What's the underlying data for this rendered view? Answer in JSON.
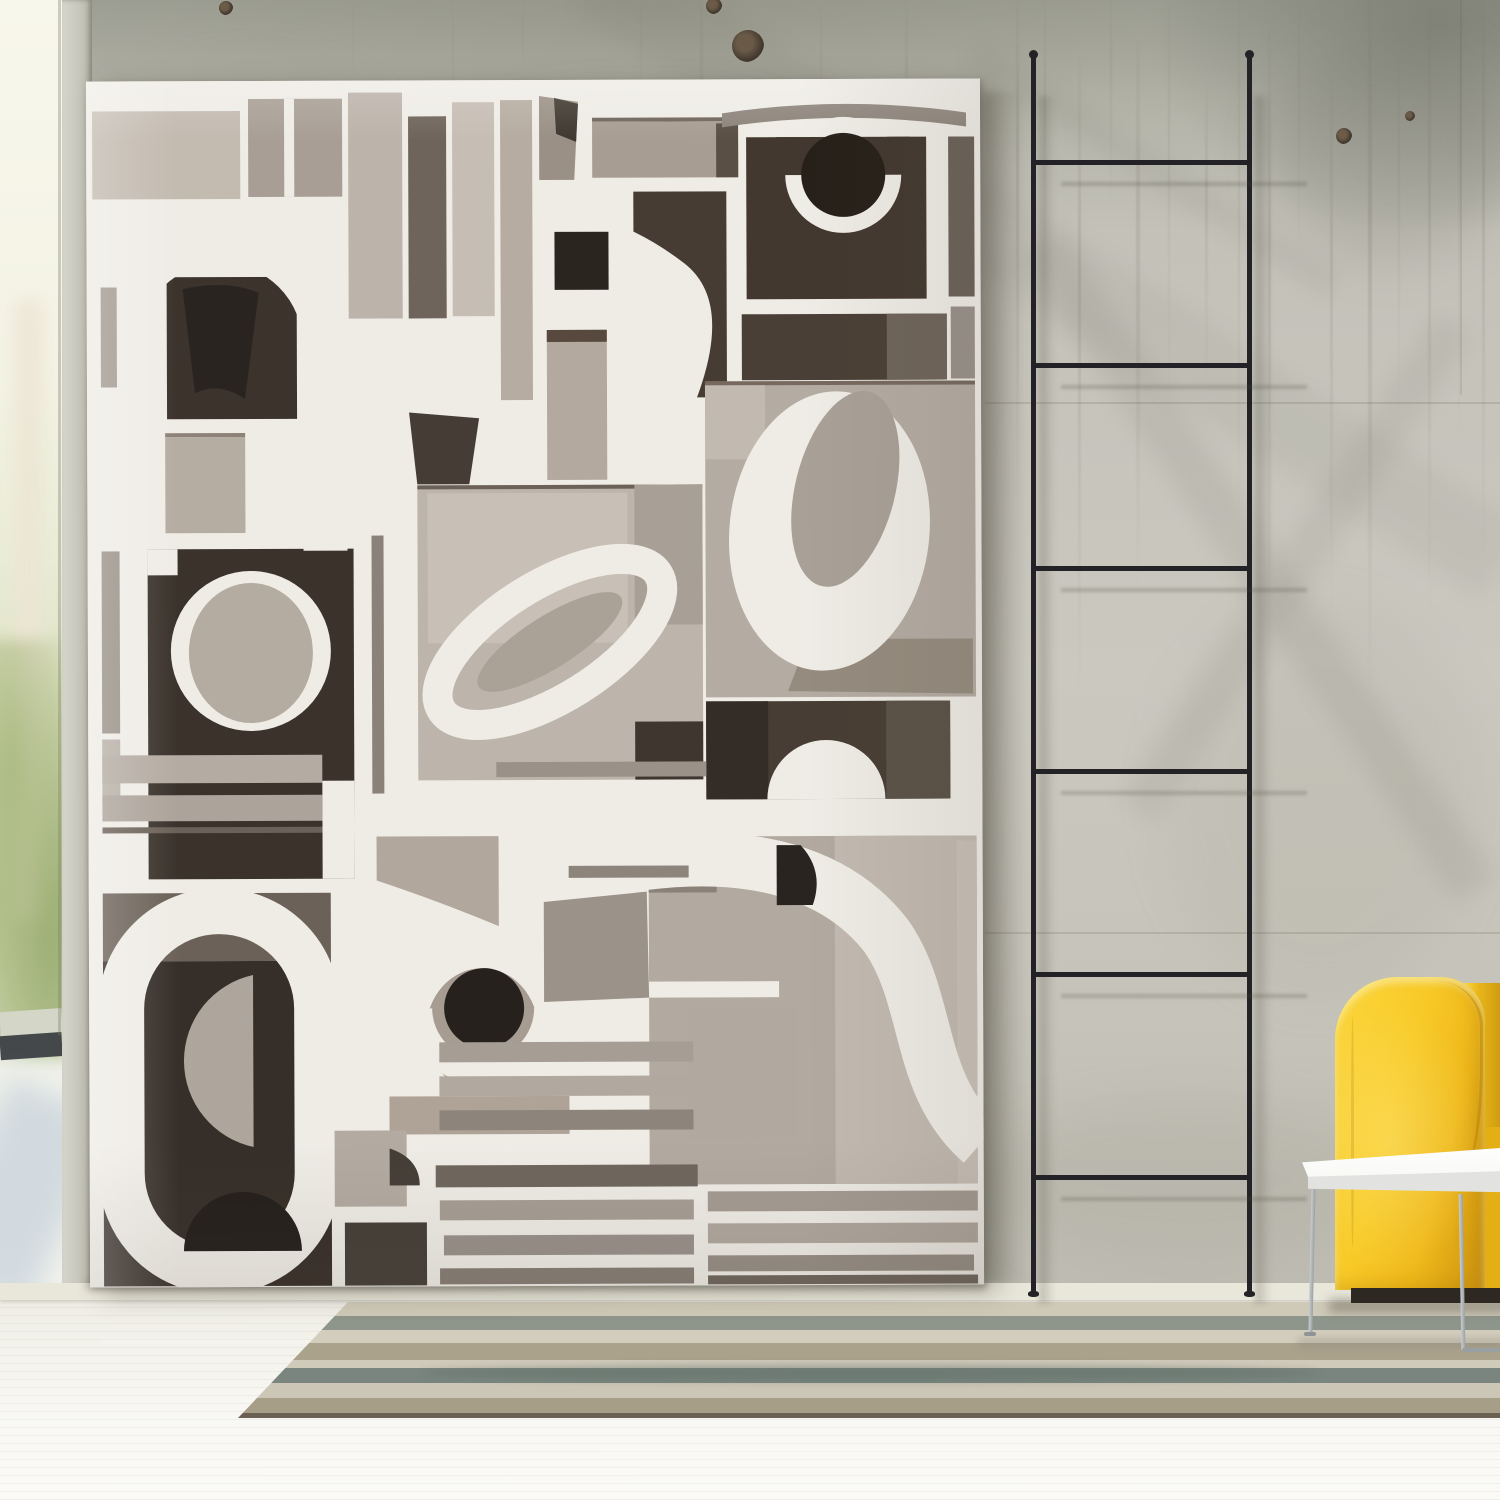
{
  "scene": {
    "description": "Interior photo: large monochrome paper-cutout abstract artwork leaning on a weathered concrete wall, thin black decor ladder, yellow sofa corner with white side table, striped rug on white wood floor, bright window at left",
    "objects": [
      "abstract-artwork-canvas",
      "concrete-wall",
      "black-ladder",
      "yellow-sofa",
      "white-side-table",
      "striped-rug",
      "white-floor",
      "window-light"
    ]
  },
  "palette": {
    "paper": "#efece6",
    "ladder": "#232327",
    "wall_base": "#c7c5bc",
    "floor": "#f2f1ea",
    "sofa_yellow": "#f8ca27",
    "sofa_base": "#2d2922",
    "table_white": "#fbfbf8",
    "table_leg": "#9aa0a3",
    "window_green": "#c2cda0",
    "art_dark": "#3a322b",
    "art_black": "#262019",
    "art_gray": "#a89e95",
    "art_light": "#c6bdb4"
  },
  "wall": {
    "streaks": [
      {
        "x": 1016,
        "y": 0,
        "w": 3,
        "h": 520,
        "o": 0.2
      },
      {
        "x": 1044,
        "y": 0,
        "w": 2,
        "h": 300,
        "o": 0.14
      },
      {
        "x": 1078,
        "y": 60,
        "w": 3,
        "h": 640,
        "o": 0.18
      },
      {
        "x": 1110,
        "y": 0,
        "w": 2,
        "h": 210,
        "o": 0.12
      },
      {
        "x": 1136,
        "y": 40,
        "w": 4,
        "h": 560,
        "o": 0.16
      },
      {
        "x": 1168,
        "y": 0,
        "w": 2,
        "h": 420,
        "o": 0.12
      },
      {
        "x": 1205,
        "y": 90,
        "w": 3,
        "h": 300,
        "o": 0.14
      },
      {
        "x": 1238,
        "y": 0,
        "w": 2,
        "h": 520,
        "o": 0.12
      },
      {
        "x": 1268,
        "y": 30,
        "w": 3,
        "h": 660,
        "o": 0.17
      },
      {
        "x": 1298,
        "y": 0,
        "w": 2,
        "h": 260,
        "o": 0.1
      },
      {
        "x": 1330,
        "y": 80,
        "w": 3,
        "h": 540,
        "o": 0.15
      },
      {
        "x": 1368,
        "y": 0,
        "w": 4,
        "h": 700,
        "o": 0.2
      },
      {
        "x": 1398,
        "y": 60,
        "w": 2,
        "h": 360,
        "o": 0.12
      },
      {
        "x": 1428,
        "y": 0,
        "w": 3,
        "h": 620,
        "o": 0.16
      },
      {
        "x": 1458,
        "y": 20,
        "w": 2,
        "h": 430,
        "o": 0.12
      },
      {
        "x": 1482,
        "y": 0,
        "w": 3,
        "h": 560,
        "o": 0.18
      },
      {
        "x": 700,
        "y": 0,
        "w": 3,
        "h": 180,
        "o": 0.1
      },
      {
        "x": 762,
        "y": 90,
        "w": 3,
        "h": 120,
        "o": 0.12
      },
      {
        "x": 820,
        "y": 0,
        "w": 2,
        "h": 150,
        "o": 0.08
      },
      {
        "x": 640,
        "y": 0,
        "w": 2,
        "h": 120,
        "o": 0.08
      },
      {
        "x": 905,
        "y": 0,
        "w": 3,
        "h": 220,
        "o": 0.1
      },
      {
        "x": 452,
        "y": 0,
        "w": 2,
        "h": 130,
        "o": 0.07
      },
      {
        "x": 522,
        "y": 0,
        "w": 2,
        "h": 90,
        "o": 0.06
      },
      {
        "x": 352,
        "y": 0,
        "w": 2,
        "h": 80,
        "o": 0.06
      }
    ],
    "blotches": [
      {
        "x": 60,
        "y": 500,
        "w": 260,
        "h": 420,
        "o": 0.08,
        "c": "#8f8b7d"
      },
      {
        "x": 1160,
        "y": 600,
        "w": 320,
        "h": 400,
        "o": 0.08,
        "c": "#827f71"
      },
      {
        "x": 1270,
        "y": 40,
        "w": 240,
        "h": 220,
        "o": 0.2,
        "c": "#6f7066"
      },
      {
        "x": 420,
        "y": 100,
        "w": 440,
        "h": 170,
        "o": 0.1,
        "c": "#83816f"
      },
      {
        "x": 980,
        "y": 1100,
        "w": 420,
        "h": 160,
        "o": 0.1,
        "c": "#7e7a6a"
      },
      {
        "x": 100,
        "y": 60,
        "w": 300,
        "h": 160,
        "o": 0.08,
        "c": "#8a8876"
      }
    ],
    "seams": [
      {
        "dir": "h",
        "x": 985,
        "y": 402,
        "len": 515
      },
      {
        "dir": "h",
        "x": 985,
        "y": 932,
        "len": 515
      },
      {
        "dir": "v",
        "x": 1460,
        "y": 0,
        "len": 395
      }
    ],
    "knots": [
      {
        "x": 748,
        "y": 46,
        "r": 16
      },
      {
        "x": 714,
        "y": 6,
        "r": 8
      },
      {
        "x": 1344,
        "y": 136,
        "r": 8
      },
      {
        "x": 1410,
        "y": 116,
        "r": 5
      },
      {
        "x": 226,
        "y": 8,
        "r": 7
      }
    ],
    "diag_bands": [
      {
        "x": 620,
        "y": -60,
        "len": 1080,
        "th": 84,
        "rot": 33,
        "o": 0.06
      },
      {
        "x": 1060,
        "y": 230,
        "len": 780,
        "th": 48,
        "rot": 56,
        "o": 0.09
      },
      {
        "x": 1120,
        "y": 800,
        "len": 580,
        "th": 42,
        "rot": -57,
        "o": 0.08
      },
      {
        "x": 980,
        "y": 40,
        "len": 430,
        "th": 28,
        "rot": 33,
        "o": 0.07
      }
    ]
  },
  "ladder": {
    "rail_left_x": 1031,
    "rail_right_x": 1247,
    "rail_width": 5,
    "top_y": 56,
    "bottom_y": 1294,
    "rungs_y": [
      160,
      363,
      566,
      769,
      972,
      1175
    ]
  },
  "rug": {
    "left": 238,
    "top": 1302,
    "width": 1262,
    "corner_inset": 110,
    "stripes": [
      {
        "h": 14,
        "c": "#cfc9b8"
      },
      {
        "h": 14,
        "c": "#8e968c"
      },
      {
        "h": 13,
        "c": "#d3cdbd"
      },
      {
        "h": 17,
        "c": "#aaa28b"
      },
      {
        "h": 8,
        "c": "#d0cabb"
      },
      {
        "h": 15,
        "c": "#79857e"
      },
      {
        "h": 15,
        "c": "#ccc6b6"
      },
      {
        "h": 15,
        "c": "#a79e87"
      },
      {
        "h": 5,
        "c": "#6a6152"
      }
    ]
  },
  "floor_streaks": [
    {
      "x": 100,
      "y": 1340,
      "w": 420,
      "h": 3,
      "o": 0.5
    },
    {
      "x": 600,
      "y": 1450,
      "w": 560,
      "h": 3,
      "o": 0.5
    },
    {
      "x": 260,
      "y": 1470,
      "w": 380,
      "h": 3,
      "o": 0.4
    },
    {
      "x": 900,
      "y": 1430,
      "w": 420,
      "h": 3,
      "o": 0.4
    }
  ],
  "artwork": {
    "x": 88,
    "y": 80,
    "w": 894,
    "h": 1206,
    "shapes": [
      {
        "t": "rect",
        "x": 6,
        "y": 30,
        "w": 148,
        "h": 88,
        "f": "#c3bab0"
      },
      {
        "t": "rect",
        "x": 162,
        "y": 18,
        "w": 94,
        "h": 98,
        "f": "#a89e95"
      },
      {
        "t": "rect",
        "x": 198,
        "y": 18,
        "w": 10,
        "h": 98,
        "f": "#efece6"
      },
      {
        "t": "rect",
        "x": 262,
        "y": 12,
        "w": 54,
        "h": 226,
        "f": "#bcb3aa"
      },
      {
        "t": "rect",
        "x": 322,
        "y": 36,
        "w": 38,
        "h": 202,
        "f": "#6e645b"
      },
      {
        "t": "rect",
        "x": 366,
        "y": 22,
        "w": 42,
        "h": 214,
        "f": "#c6bdb4"
      },
      {
        "t": "rect",
        "x": 414,
        "y": 20,
        "w": 32,
        "h": 300,
        "f": "#b6aca1"
      },
      {
        "t": "path",
        "d": "M453,16 L492,22 L488,100 L453,100 Z",
        "f": "#9a9086"
      },
      {
        "t": "path",
        "d": "M468,18 L492,24 L490,62 L470,54 Z",
        "f": "#3f3830"
      },
      {
        "t": "rect",
        "x": 468,
        "y": 152,
        "w": 54,
        "h": 58,
        "f": "#2b2520"
      },
      {
        "t": "rect",
        "x": 506,
        "y": 38,
        "w": 146,
        "h": 4,
        "f": "#6f655c"
      },
      {
        "t": "rect",
        "x": 506,
        "y": 42,
        "w": 146,
        "h": 56,
        "f": "#a89d92"
      },
      {
        "t": "rect",
        "x": 630,
        "y": 44,
        "w": 22,
        "h": 54,
        "f": "#5a4f45"
      },
      {
        "t": "path",
        "d": "M547,112 L640,112 L640,318 L610,318 Q646,222 598,184 Q572,164 547,152 Z",
        "f": "#463c33"
      },
      {
        "t": "rect",
        "x": 460,
        "y": 250,
        "w": 60,
        "h": 150,
        "f": "#b3a99e"
      },
      {
        "t": "rect",
        "x": 460,
        "y": 250,
        "w": 60,
        "h": 12,
        "f": "#57493d"
      },
      {
        "t": "path",
        "d": "M636,34 Q758,16 880,34 L880,48 Q758,30 636,48 Z",
        "f": "#8d847b"
      },
      {
        "t": "rect",
        "x": 660,
        "y": 58,
        "w": 180,
        "h": 162,
        "f": "#42382f"
      },
      {
        "t": "circle",
        "cx": 757,
        "cy": 96,
        "r": 58,
        "f": "#efece6"
      },
      {
        "t": "rect",
        "x": 690,
        "y": 58,
        "w": 134,
        "h": 38,
        "f": "#42382f"
      },
      {
        "t": "circle",
        "cx": 757,
        "cy": 96,
        "r": 42,
        "f": "#262019"
      },
      {
        "t": "rect",
        "x": 862,
        "y": 58,
        "w": 26,
        "h": 160,
        "f": "#6b6158"
      },
      {
        "t": "rect",
        "x": 655,
        "y": 235,
        "w": 205,
        "h": 66,
        "f": "#4a3f36"
      },
      {
        "t": "rect",
        "x": 800,
        "y": 235,
        "w": 60,
        "h": 66,
        "f": "#6e6459"
      },
      {
        "t": "rect",
        "x": 864,
        "y": 228,
        "w": 24,
        "h": 72,
        "f": "#99908a"
      },
      {
        "t": "rect",
        "x": 618,
        "y": 302,
        "w": 270,
        "h": 316,
        "f": "#b4aba2"
      },
      {
        "t": "rect",
        "x": 618,
        "y": 302,
        "w": 270,
        "h": 4,
        "f": "#77695e"
      },
      {
        "t": "rect",
        "x": 618,
        "y": 306,
        "w": 60,
        "h": 74,
        "f": "#c2b9b0"
      },
      {
        "t": "path",
        "d": "M720,560 L885,560 L885,615 L700,612 Z",
        "f": "#958b7e"
      },
      {
        "t": "ellipse",
        "cx": 742,
        "cy": 452,
        "rx": 100,
        "ry": 140,
        "rot": 6,
        "f": "#efece6"
      },
      {
        "t": "ellipse",
        "cx": 758,
        "cy": 410,
        "rx": 50,
        "ry": 100,
        "rot": 14,
        "f": "#a9a097"
      },
      {
        "t": "rect",
        "x": 618,
        "y": 622,
        "w": 244,
        "h": 98,
        "f": "#473d34"
      },
      {
        "t": "rect",
        "x": 618,
        "y": 622,
        "w": 62,
        "h": 98,
        "f": "#342c26"
      },
      {
        "t": "rect",
        "x": 798,
        "y": 622,
        "w": 64,
        "h": 98,
        "f": "#5a5147"
      },
      {
        "t": "path",
        "d": "M679,720 A59,59 0 0 1 797,720 Z",
        "f": "#efece6"
      },
      {
        "t": "rect",
        "x": 560,
        "y": 757,
        "w": 328,
        "h": 348,
        "f": "#b2a9a0"
      },
      {
        "t": "rect",
        "x": 746,
        "y": 757,
        "w": 142,
        "h": 348,
        "f": "#c2b9b0"
      },
      {
        "t": "rect",
        "x": 560,
        "y": 757,
        "w": 68,
        "h": 56,
        "f": "#8a8178"
      },
      {
        "t": "rect",
        "x": 868,
        "y": 762,
        "w": 20,
        "h": 343,
        "f": "#c9c0b7"
      },
      {
        "t": "rect",
        "x": 598,
        "y": 928,
        "w": 110,
        "h": 130,
        "f": "#b1a89f"
      },
      {
        "t": "rect",
        "x": 560,
        "y": 902,
        "w": 130,
        "h": 16,
        "f": "#efece6"
      },
      {
        "t": "path",
        "d": "M552,784 C660,770 748,792 798,858 C842,922 826,1006 892,1064",
        "s": "#efece6",
        "sw": 54
      },
      {
        "t": "path",
        "d": "M688,766 L712,766 Q736,792 724,826 L688,826 Z",
        "f": "#2a2420"
      },
      {
        "t": "rect",
        "x": 618,
        "y": 1112,
        "w": 270,
        "h": 20,
        "f": "#a49b92"
      },
      {
        "t": "rect",
        "x": 618,
        "y": 1144,
        "w": 270,
        "h": 20,
        "f": "#b0a79e"
      },
      {
        "t": "rect",
        "x": 618,
        "y": 1176,
        "w": 266,
        "h": 16,
        "f": "#968d84"
      },
      {
        "t": "rect",
        "x": 618,
        "y": 1196,
        "w": 270,
        "h": 9,
        "f": "#6e645c"
      },
      {
        "t": "rect",
        "x": 330,
        "y": 405,
        "w": 285,
        "h": 295,
        "f": "#bdb4ab"
      },
      {
        "t": "rect",
        "x": 330,
        "y": 405,
        "w": 285,
        "h": 4,
        "f": "#6b6158"
      },
      {
        "t": "rect",
        "x": 340,
        "y": 413,
        "w": 200,
        "h": 150,
        "f": "#c8bfb6"
      },
      {
        "t": "rect",
        "x": 547,
        "y": 405,
        "w": 68,
        "h": 140,
        "f": "#a89f96"
      },
      {
        "t": "rect",
        "x": 547,
        "y": 642,
        "w": 68,
        "h": 58,
        "f": "#3e362f"
      },
      {
        "t": "path",
        "d": "M322,332 L392,338 L382,404 L330,404 Z",
        "f": "#453d35"
      },
      {
        "t": "ellipse",
        "cx": 462,
        "cy": 562,
        "rx": 128,
        "ry": 56,
        "rot": -32,
        "s": "#efece6",
        "sw": 30
      },
      {
        "t": "ellipse",
        "cx": 462,
        "cy": 562,
        "rx": 84,
        "ry": 26,
        "rot": -32,
        "f": "#aaa197"
      },
      {
        "t": "rect",
        "x": 408,
        "y": 682,
        "w": 210,
        "h": 15,
        "f": "#9a9188"
      },
      {
        "t": "rect",
        "x": 78,
        "y": 352,
        "w": 80,
        "h": 4,
        "f": "#8d8278"
      },
      {
        "t": "rect",
        "x": 78,
        "y": 356,
        "w": 80,
        "h": 96,
        "f": "#b5aca2"
      },
      {
        "t": "rect",
        "x": 14,
        "y": 420,
        "w": 18,
        "h": 232,
        "f": "#9a9188"
      },
      {
        "t": "rect",
        "x": 14,
        "y": 658,
        "w": 18,
        "h": 66,
        "f": "#b8afa6"
      },
      {
        "t": "rect",
        "x": 60,
        "y": 468,
        "w": 206,
        "h": 330,
        "f": "#3a322b"
      },
      {
        "t": "circle",
        "cx": 163,
        "cy": 570,
        "r": 80,
        "f": "#efece6"
      },
      {
        "t": "ellipse",
        "cx": 163,
        "cy": 572,
        "rx": 62,
        "ry": 70,
        "rot": 0,
        "f": "#b4aba1"
      },
      {
        "t": "rect",
        "x": 60,
        "y": 468,
        "w": 30,
        "h": 26,
        "f": "#efece6"
      },
      {
        "t": "rect",
        "x": 234,
        "y": 700,
        "w": 32,
        "h": 98,
        "f": "#efece6"
      },
      {
        "t": "rect",
        "x": 284,
        "y": 455,
        "w": 12,
        "h": 258,
        "f": "#8a8178"
      },
      {
        "t": "rect",
        "x": 80,
        "y": 196,
        "w": 130,
        "h": 142,
        "f": "#3b332c"
      },
      {
        "t": "path",
        "d": "M96,208 Q140,198 172,212 L158,318 Q132,300 108,312 Z",
        "f": "#29241f"
      },
      {
        "t": "path",
        "d": "M30,470 L30,264 A104,104 0 0 1 238,264 L238,470",
        "s": "#efece6",
        "sw": 44
      },
      {
        "t": "rect",
        "x": 14,
        "y": 206,
        "w": 16,
        "h": 100,
        "f": "#a39a91"
      },
      {
        "t": "rect",
        "x": 14,
        "y": 674,
        "w": 220,
        "h": 28,
        "f": "#b4aba2"
      },
      {
        "t": "rect",
        "x": 14,
        "y": 714,
        "w": 220,
        "h": 26,
        "f": "#aca39a"
      },
      {
        "t": "rect",
        "x": 14,
        "y": 746,
        "w": 220,
        "h": 6,
        "f": "#6b6158"
      },
      {
        "t": "rect",
        "x": 14,
        "y": 812,
        "w": 228,
        "h": 68,
        "f": "#6b6158"
      },
      {
        "t": "rect",
        "x": 14,
        "y": 880,
        "w": 228,
        "h": 325,
        "f": "#362e28"
      },
      {
        "t": "rect",
        "x": 32,
        "y": 830,
        "w": 196,
        "h": 360,
        "rx": 98,
        "s": "#efece6",
        "sw": 46
      },
      {
        "t": "path",
        "d": "M164,894 A88,88 0 0 0 164,1066 Z",
        "f": "#aea59c"
      },
      {
        "t": "path",
        "d": "M94,1170 A59,59 0 0 1 212,1170 Z",
        "f": "#241f1b"
      },
      {
        "t": "path",
        "d": "M288,756 L410,756 L410,846 Q348,820 288,800 Z",
        "f": "#b2a79c"
      },
      {
        "t": "rect",
        "x": 480,
        "y": 786,
        "w": 120,
        "h": 12,
        "f": "#8d847b"
      },
      {
        "t": "path",
        "d": "M455,822 L558,812 L560,918 L455,922 Z",
        "f": "#9b9289"
      },
      {
        "t": "ellipse",
        "cx": 393,
        "cy": 950,
        "rx": 56,
        "ry": 62,
        "rot": 0,
        "f": "#a79c91"
      },
      {
        "t": "path",
        "d": "M330,928 A64,64 0 1 0 458,928",
        "s": "#efece6",
        "sw": 26
      },
      {
        "t": "circle",
        "cx": 395,
        "cy": 928,
        "r": 40,
        "f": "#26211d"
      },
      {
        "t": "rect",
        "x": 300,
        "y": 1016,
        "w": 180,
        "h": 38,
        "f": "#aea396"
      },
      {
        "t": "rect",
        "x": 245,
        "y": 1050,
        "w": 72,
        "h": 76,
        "f": "#b3aaa1"
      },
      {
        "t": "path",
        "d": "M300,1068 Q330,1078 330,1105 L300,1105 Z",
        "f": "#453e37"
      },
      {
        "t": "rect",
        "x": 255,
        "y": 1142,
        "w": 82,
        "h": 63,
        "f": "#453e37"
      },
      {
        "t": "rect",
        "x": 350,
        "y": 962,
        "w": 254,
        "h": 20,
        "f": "#a69d94"
      },
      {
        "t": "rect",
        "x": 350,
        "y": 996,
        "w": 258,
        "h": 20,
        "f": "#b1a89f"
      },
      {
        "t": "rect",
        "x": 350,
        "y": 1030,
        "w": 254,
        "h": 20,
        "f": "#8d847b"
      },
      {
        "t": "rect",
        "x": 346,
        "y": 1085,
        "w": 262,
        "h": 22,
        "f": "#6f665e"
      },
      {
        "t": "rect",
        "x": 350,
        "y": 1120,
        "w": 254,
        "h": 20,
        "f": "#a69d94"
      },
      {
        "t": "rect",
        "x": 354,
        "y": 1155,
        "w": 250,
        "h": 20,
        "f": "#99908a"
      },
      {
        "t": "rect",
        "x": 350,
        "y": 1188,
        "w": 254,
        "h": 16,
        "f": "#857c73"
      }
    ]
  }
}
